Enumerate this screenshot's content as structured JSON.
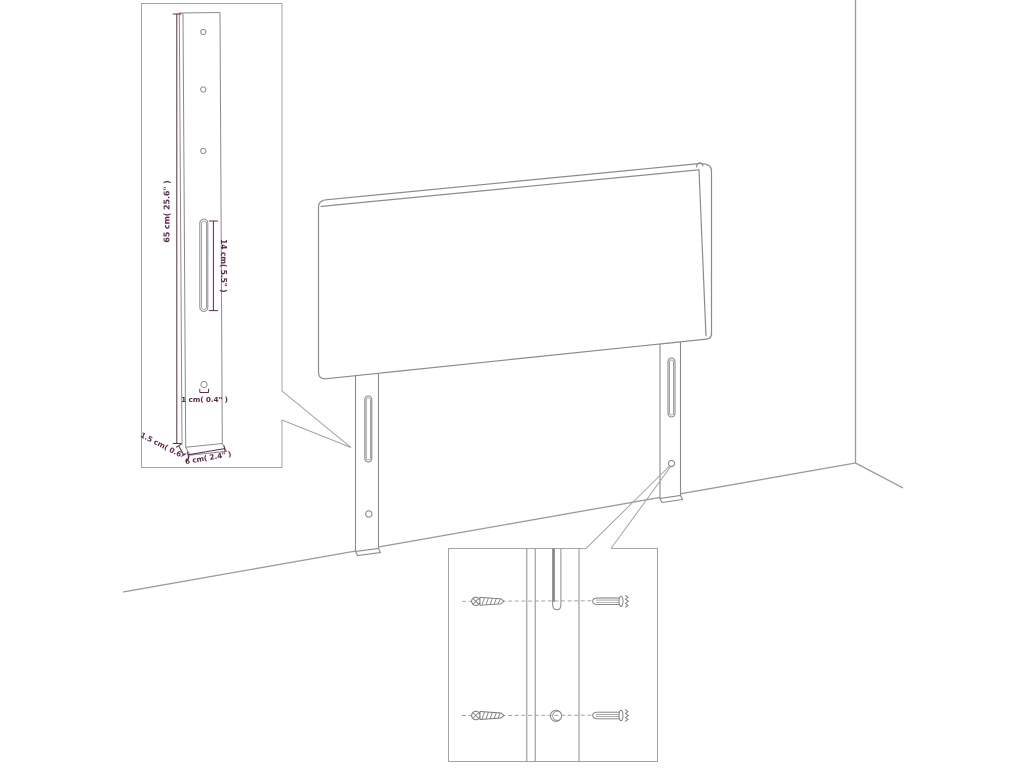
{
  "diagram": {
    "type": "product-dimension-diagram",
    "dimensions": {
      "bracket_height": "65 cm( 25.6\" )",
      "slot_length": "14 cm( 5.5\" )",
      "hole_diameter": "1 cm( 0.4\" )",
      "bracket_thickness": "1.5 cm( 0.6\" )",
      "bracket_width": "6 cm( 2.4\" )"
    },
    "colors": {
      "product_line": "#8b8b8b",
      "wall_line": "#9b9b9b",
      "dimension": "#5b2a4e",
      "background": "#ffffff"
    }
  }
}
